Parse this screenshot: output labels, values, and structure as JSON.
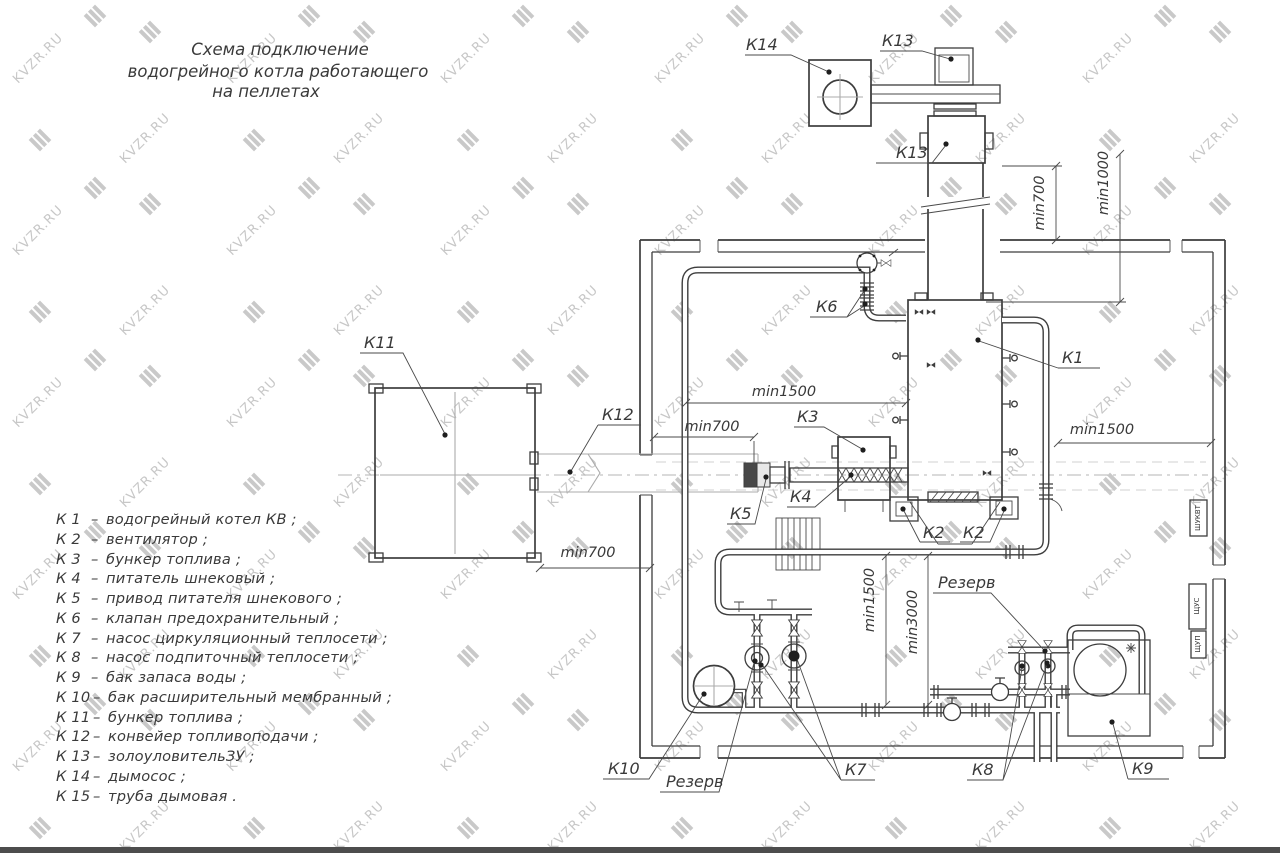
{
  "watermark": {
    "text": "KVZR.RU",
    "color": "#c7c7c7"
  },
  "title": {
    "line1": "Схема подключение",
    "line2": "водогрейного котла работающего",
    "line3": "на пеллетах"
  },
  "legend": {
    "separator": "–",
    "items": [
      {
        "code": "К 1",
        "name": "водогрейный котел КВ ;"
      },
      {
        "code": "К 2",
        "name": "вентилятор ;"
      },
      {
        "code": "К 3",
        "name": "бункер топлива ;"
      },
      {
        "code": "К 4",
        "name": "питатель шнековый ;"
      },
      {
        "code": "К 5",
        "name": "привод питателя шнекового ;"
      },
      {
        "code": "К 6",
        "name": "клапан предохранительный ;"
      },
      {
        "code": "К 7",
        "name": "насос циркуляционный теплосети ;"
      },
      {
        "code": "К 8",
        "name": "насос подпиточный теплосети ;"
      },
      {
        "code": "К 9",
        "name": "бак запаса воды ;"
      },
      {
        "code": "К 10",
        "name": "бак расширительный мембранный ;"
      },
      {
        "code": "К 11",
        "name": "бункер топлива ;"
      },
      {
        "code": "К 12",
        "name": "конвейер топливоподачи ;"
      },
      {
        "code": "К 13",
        "name": "золоуловительЗУ ;"
      },
      {
        "code": "К 14",
        "name": "дымосос ;"
      },
      {
        "code": "К 15",
        "name": "труба дымовая ."
      }
    ]
  },
  "callouts": {
    "k1": "К1",
    "k2": "К2",
    "k3": "К3",
    "k4": "К4",
    "k5": "К5",
    "k6": "К6",
    "k7": "К7",
    "k8": "К8",
    "k9": "К9",
    "k10": "К10",
    "k11": "К11",
    "k12": "К12",
    "k13": "К13",
    "k14": "К14",
    "reserve": "Резерв"
  },
  "dimensions": {
    "min700": "min700",
    "min1000": "min1000",
    "min1500": "min1500",
    "min3000": "min3000"
  },
  "panels": {
    "p1": "ШУКВТ",
    "p2": "ЩУС",
    "p3": "ЩУП"
  },
  "colors": {
    "ink": "#3d3d3d",
    "watermark": "#c7c7c7",
    "background": "#ffffff",
    "bottom_bar": "#4d4d4d"
  }
}
